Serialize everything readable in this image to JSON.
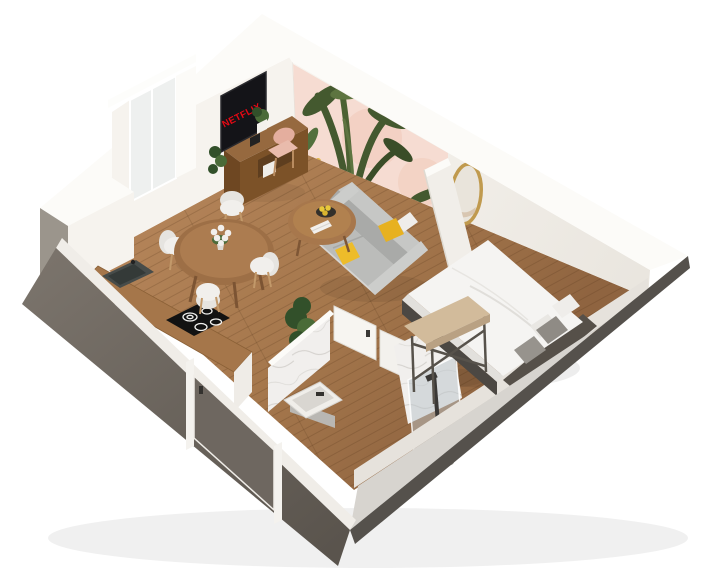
{
  "scene": {
    "description": "3D isometric render of a small studio apartment floor plan",
    "background": "#ffffff",
    "tv": {
      "brand_text": "NETFLIX",
      "brand_color": "#e50914"
    },
    "rooms": [
      "living-room",
      "dining-area",
      "kitchen",
      "bathroom",
      "bedroom",
      "entry"
    ],
    "objects": [
      "wall-mural",
      "tv",
      "tv-desk",
      "desk-chair",
      "hanging-plant",
      "window",
      "dining-table",
      "dining-chairs",
      "flower-vase",
      "kitchen-counter",
      "sink",
      "cooktop",
      "sofa",
      "yellow-pillows",
      "coffee-table",
      "fruit-bowl",
      "books",
      "floor-plant",
      "partition-wall",
      "oval-mirror",
      "bed",
      "bed-pillows",
      "headboard",
      "bed-bench",
      "bathroom-doors",
      "washbasin",
      "shower",
      "shower-glass",
      "entry-door"
    ]
  },
  "counts": {
    "dining_chairs": 4,
    "sofa_pillows": 2,
    "bed_pillows": 4,
    "cooktop_burners": 4
  },
  "palette": {
    "background": "#ffffff",
    "wall_white": "#f6f3ee",
    "wall_top": "#fcfbf8",
    "wall_shadow": "#e7e3dc",
    "ne_wall_face": "#f2efe9",
    "sw_wall_dark": "#6e675f",
    "sw_wall_darker": "#58524b",
    "se_wall_top": "#d7d4cf",
    "se_wall_side": "#55514c",
    "trim_white": "#f0ede8",
    "corner_block_side": "#9b958c",
    "floor_wood": "#a97c52",
    "floor_wood_dark": "#8d6240",
    "plank_line": "rgba(80,48,24,0.22)",
    "mural_pink": "#f6dcd2",
    "mural_peach": "#f0c9b8",
    "mural_leaf": "#44592f",
    "mural_leaf_light": "#5d7440",
    "mural_flower": "#d08ba1",
    "tv_screen": "#141418",
    "netflix_red": "#e50914",
    "desk_wood": "#96693f",
    "desk_wood_dark": "#7c5228",
    "counter_wood": "#a5764a",
    "cooktop_black": "#121212",
    "sink_dark": "#474c4a",
    "chair_white": "#f1efec",
    "chair_leg": "#c2996a",
    "table_wood": "#9d6f46",
    "table_wood_light": "#ac7c50",
    "sofa_grey": "#bbbcba",
    "sofa_grey_dark": "#a9aaa8",
    "sofa_back": "#c6c7c5",
    "sofa_base": "#d6d5d2",
    "pillow_yellow": "#e7b120",
    "plant_green": "#32502a",
    "plant_green_light": "#4a6b38",
    "marble_white": "#f1efed",
    "marble_vein": "#b9b6b1",
    "glass_blue": "rgba(185,196,201,0.5)",
    "duvet_white": "#f5f4f2",
    "duvet_shade": "#e2e0dc",
    "pillow_grey": "#8f8b85",
    "pillow_white": "#efedea",
    "headboard_dark": "#565049",
    "bed_frame": "#4c4843",
    "bench_wood": "#d2bb9b",
    "metal_dark": "#57524b",
    "mirror_gold": "#c09a4e",
    "mirror_glass": "#e9e4db",
    "door_taupe": "#6e6760",
    "pink_chair": "#e9bbac",
    "basin_white": "#f0eeea",
    "basin_inner": "#d9d6d1",
    "fixture_dark": "#33312e"
  }
}
